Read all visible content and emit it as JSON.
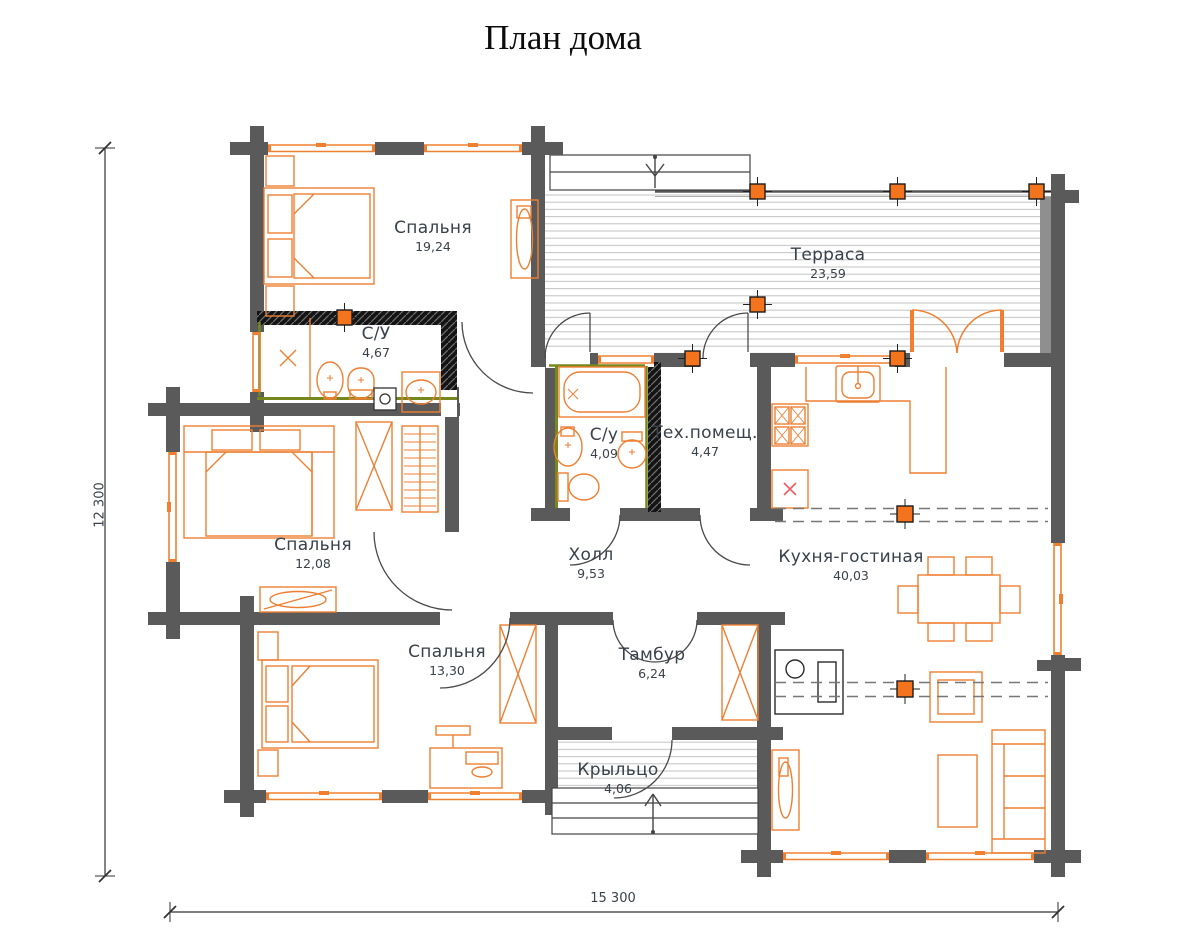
{
  "title": "План дома",
  "rooms": [
    {
      "id": "bedroom1",
      "name": "Спальня",
      "area": "19,24"
    },
    {
      "id": "terrace",
      "name": "Терраса",
      "area": "23,59"
    },
    {
      "id": "bath1",
      "name": "С/У",
      "area": "4,67"
    },
    {
      "id": "bath2",
      "name": "С/у",
      "area": "4,09"
    },
    {
      "id": "tech",
      "name": "Тех.помещ.",
      "area": "4,47"
    },
    {
      "id": "bedroom2",
      "name": "Спальня",
      "area": "12,08"
    },
    {
      "id": "hall",
      "name": "Холл",
      "area": "9,53"
    },
    {
      "id": "kitchen_living",
      "name": "Кухня-гостиная",
      "area": "40,03"
    },
    {
      "id": "bedroom3",
      "name": "Спальня",
      "area": "13,30"
    },
    {
      "id": "tambour",
      "name": "Тамбур",
      "area": "6,24"
    },
    {
      "id": "porch",
      "name": "Крыльцо",
      "area": "4,06"
    }
  ],
  "dimensions": {
    "vertical": "12 300",
    "horizontal": "15 300"
  },
  "colors": {
    "wall": "#5a5a5a",
    "furniture_outline": "#ee7f33",
    "post_accent": "#f4731d",
    "waterproofing_green": "#75871d",
    "hatched_wall": "#141414",
    "label_text": "#39414a",
    "deck_stripe": "#c2c2c2"
  }
}
